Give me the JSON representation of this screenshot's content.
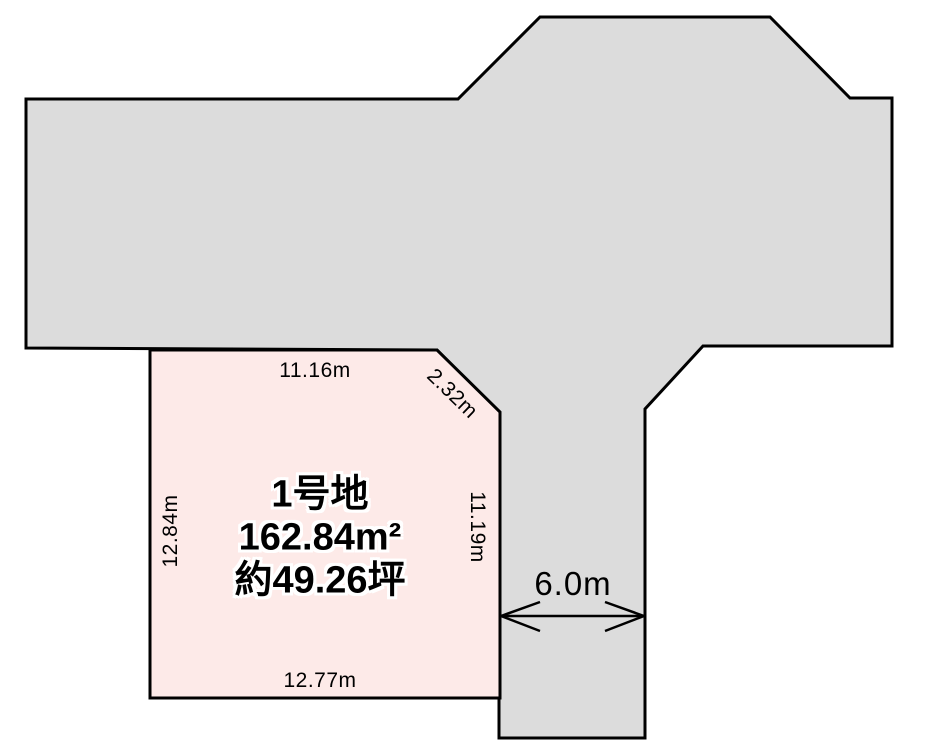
{
  "diagram": {
    "parcel": {
      "name": "1号地",
      "area_m2": "162.84m²",
      "area_tsubo": "約49.26坪",
      "dimensions": {
        "top": "11.16m",
        "corner": "2.32m",
        "left": "12.84m",
        "right": "11.19m",
        "bottom": "12.77m"
      }
    },
    "road": {
      "width_label": "6.0m"
    },
    "colors": {
      "road_fill": "#dcdcdc",
      "parcel_fill": "#fdeae8",
      "line": "#000000"
    }
  }
}
